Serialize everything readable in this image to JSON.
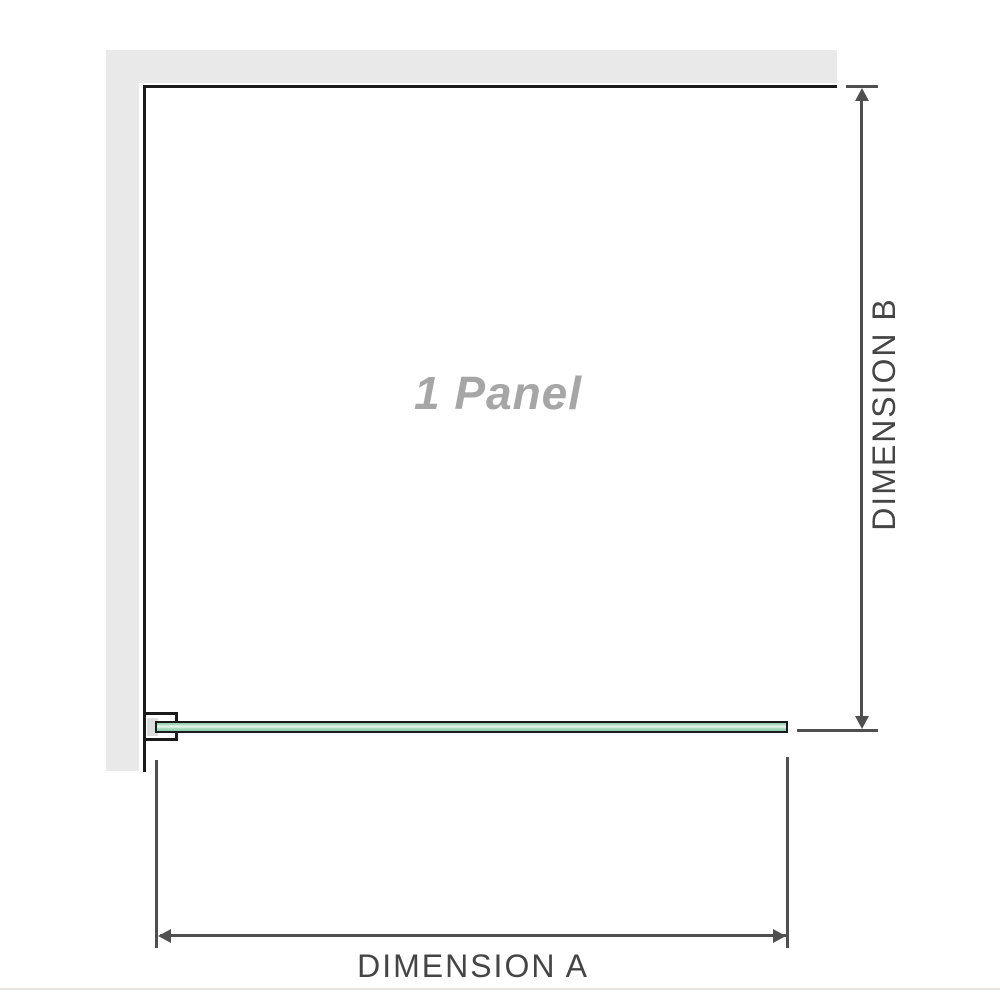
{
  "diagram": {
    "title": "1 Panel",
    "dimension_a": {
      "label": "DIMENSION A"
    },
    "dimension_b": {
      "label": "DIMENSION B"
    }
  },
  "colors": {
    "wall_gray": "#e9e9e9",
    "outline_black": "#1a1a1a",
    "dimension_line_gray": "#4f4f4f",
    "dimension_text_gray": "#454545",
    "panel_text_gray": "#a6a6a6",
    "glass_green": "#8fcfae",
    "glass_highlight": "#ecf7f0",
    "bracket_pad_gray": "#dcdcdc",
    "baseline_light": "#e8e5e0"
  }
}
